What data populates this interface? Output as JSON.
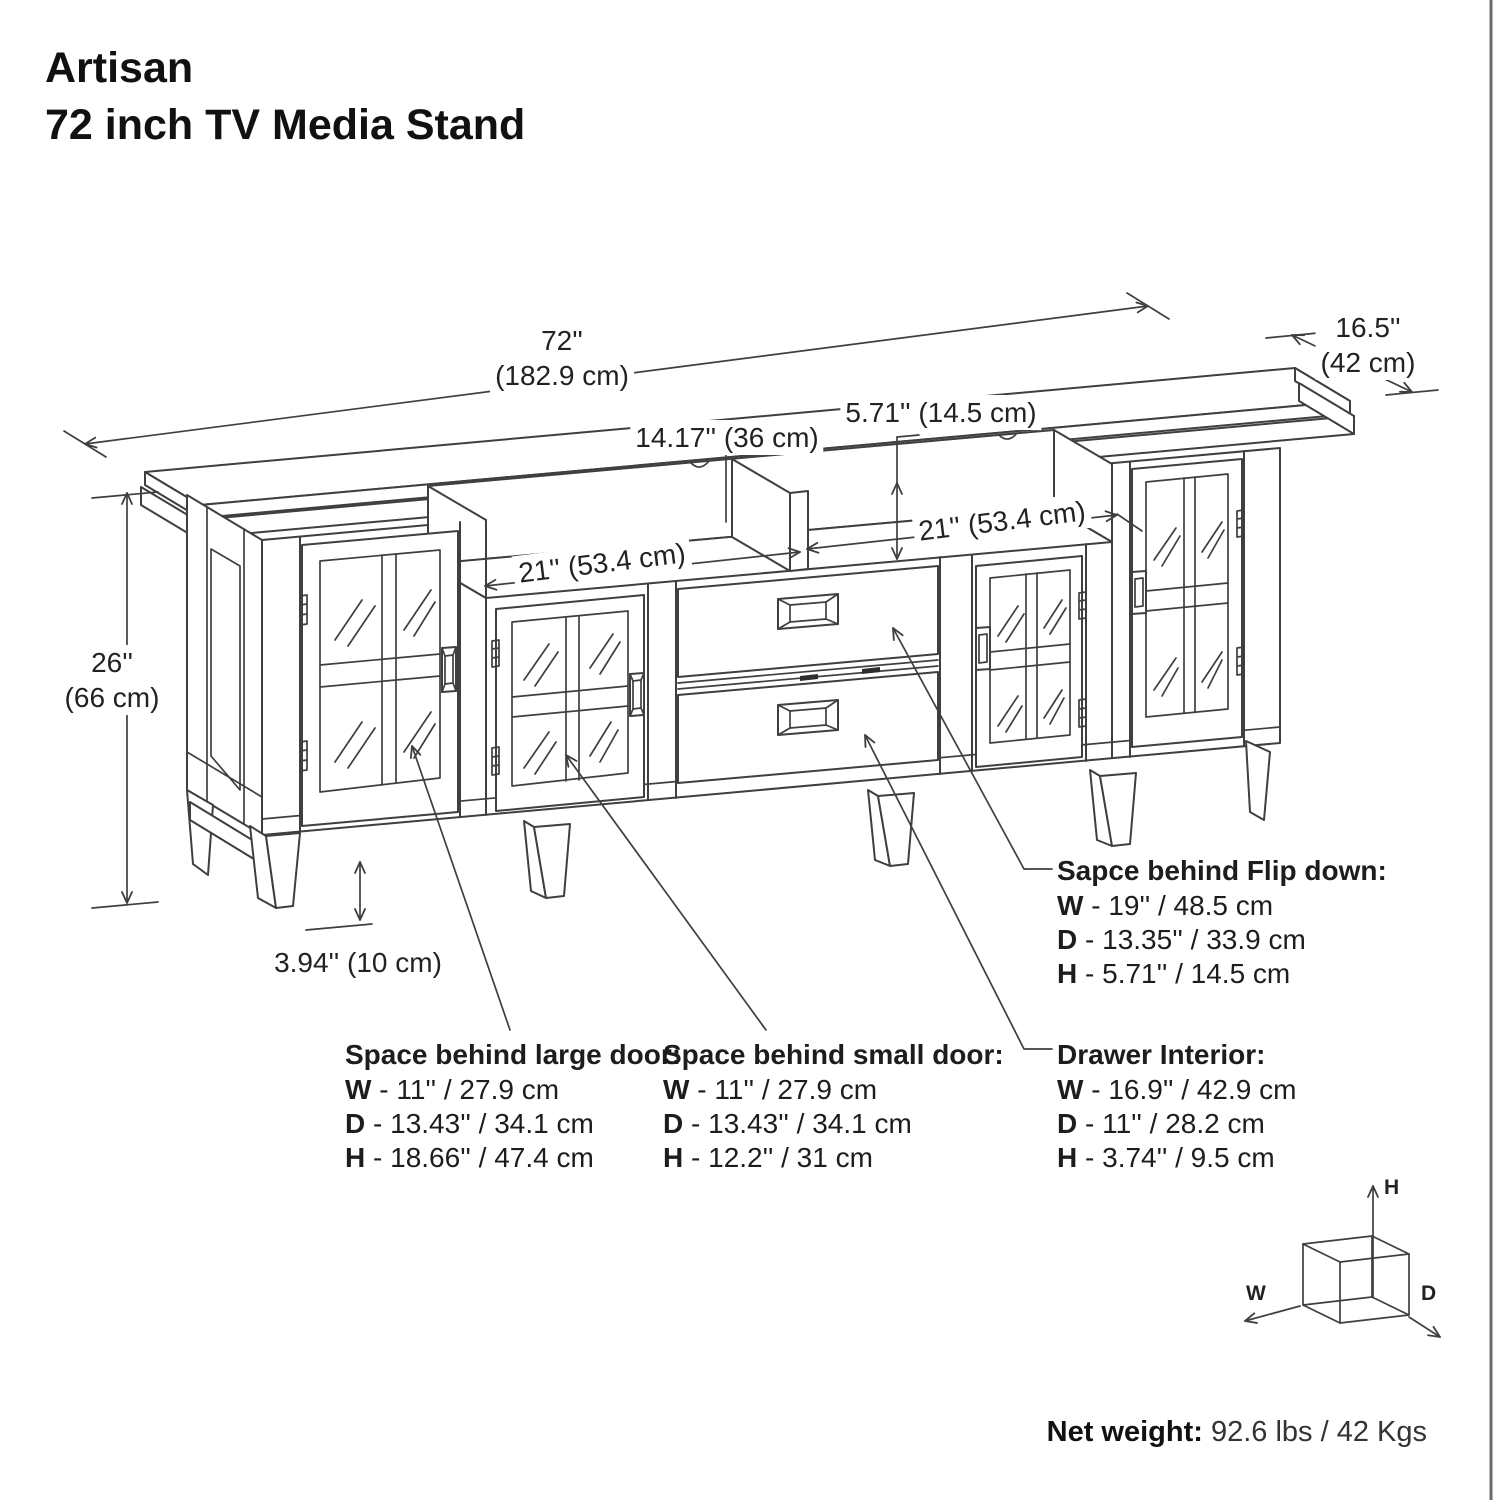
{
  "title": {
    "line1": "Artisan",
    "line2": "72 inch TV Media Stand"
  },
  "dimensions": {
    "width": {
      "in": "72''",
      "cm": "(182.9 cm)"
    },
    "depth": {
      "in": "16.5''",
      "cm": "(42 cm)"
    },
    "height": {
      "in": "26''",
      "cm": "(66 cm)"
    },
    "leg_height": {
      "text": "3.94'' (10 cm)"
    },
    "shelf_center": {
      "text": "14.17'' (36 cm)"
    },
    "opening_height": {
      "text": "5.71'' (14.5 cm)"
    },
    "shelf_left": {
      "text": "21'' (53.4 cm)"
    },
    "shelf_right": {
      "text": "21'' (53.4 cm)"
    }
  },
  "specs": {
    "flip_down": {
      "heading": "Sapce behind Flip down:",
      "rows": [
        {
          "k": "W",
          "v": "- 19'' / 48.5 cm"
        },
        {
          "k": "D",
          "v": "- 13.35'' / 33.9 cm"
        },
        {
          "k": "H",
          "v": "- 5.71'' / 14.5 cm"
        }
      ]
    },
    "large_door": {
      "heading": "Space behind large door:",
      "rows": [
        {
          "k": "W",
          "v": "- 11'' / 27.9 cm"
        },
        {
          "k": "D",
          "v": "- 13.43'' / 34.1 cm"
        },
        {
          "k": "H",
          "v": "- 18.66'' / 47.4 cm"
        }
      ]
    },
    "small_door": {
      "heading": "Space behind small door:",
      "rows": [
        {
          "k": "W",
          "v": "- 11'' / 27.9 cm"
        },
        {
          "k": "D",
          "v": "- 13.43'' / 34.1 cm"
        },
        {
          "k": "H",
          "v": "- 12.2'' / 31 cm"
        }
      ]
    },
    "drawer": {
      "heading": "Drawer Interior:",
      "rows": [
        {
          "k": "W",
          "v": "- 16.9'' / 42.9 cm"
        },
        {
          "k": "D",
          "v": "- 11'' / 28.2 cm"
        },
        {
          "k": "H",
          "v": "- 3.74'' / 9.5 cm"
        }
      ]
    }
  },
  "axis_cube": {
    "h": "H",
    "w": "W",
    "d": "D"
  },
  "footer": {
    "net_weight_label": "Net weight:",
    "net_weight_value": "92.6 lbs / 42 Kgs"
  },
  "colors": {
    "line": "#3f3f3f",
    "text": "#1d1d1d",
    "background": "#ffffff"
  }
}
